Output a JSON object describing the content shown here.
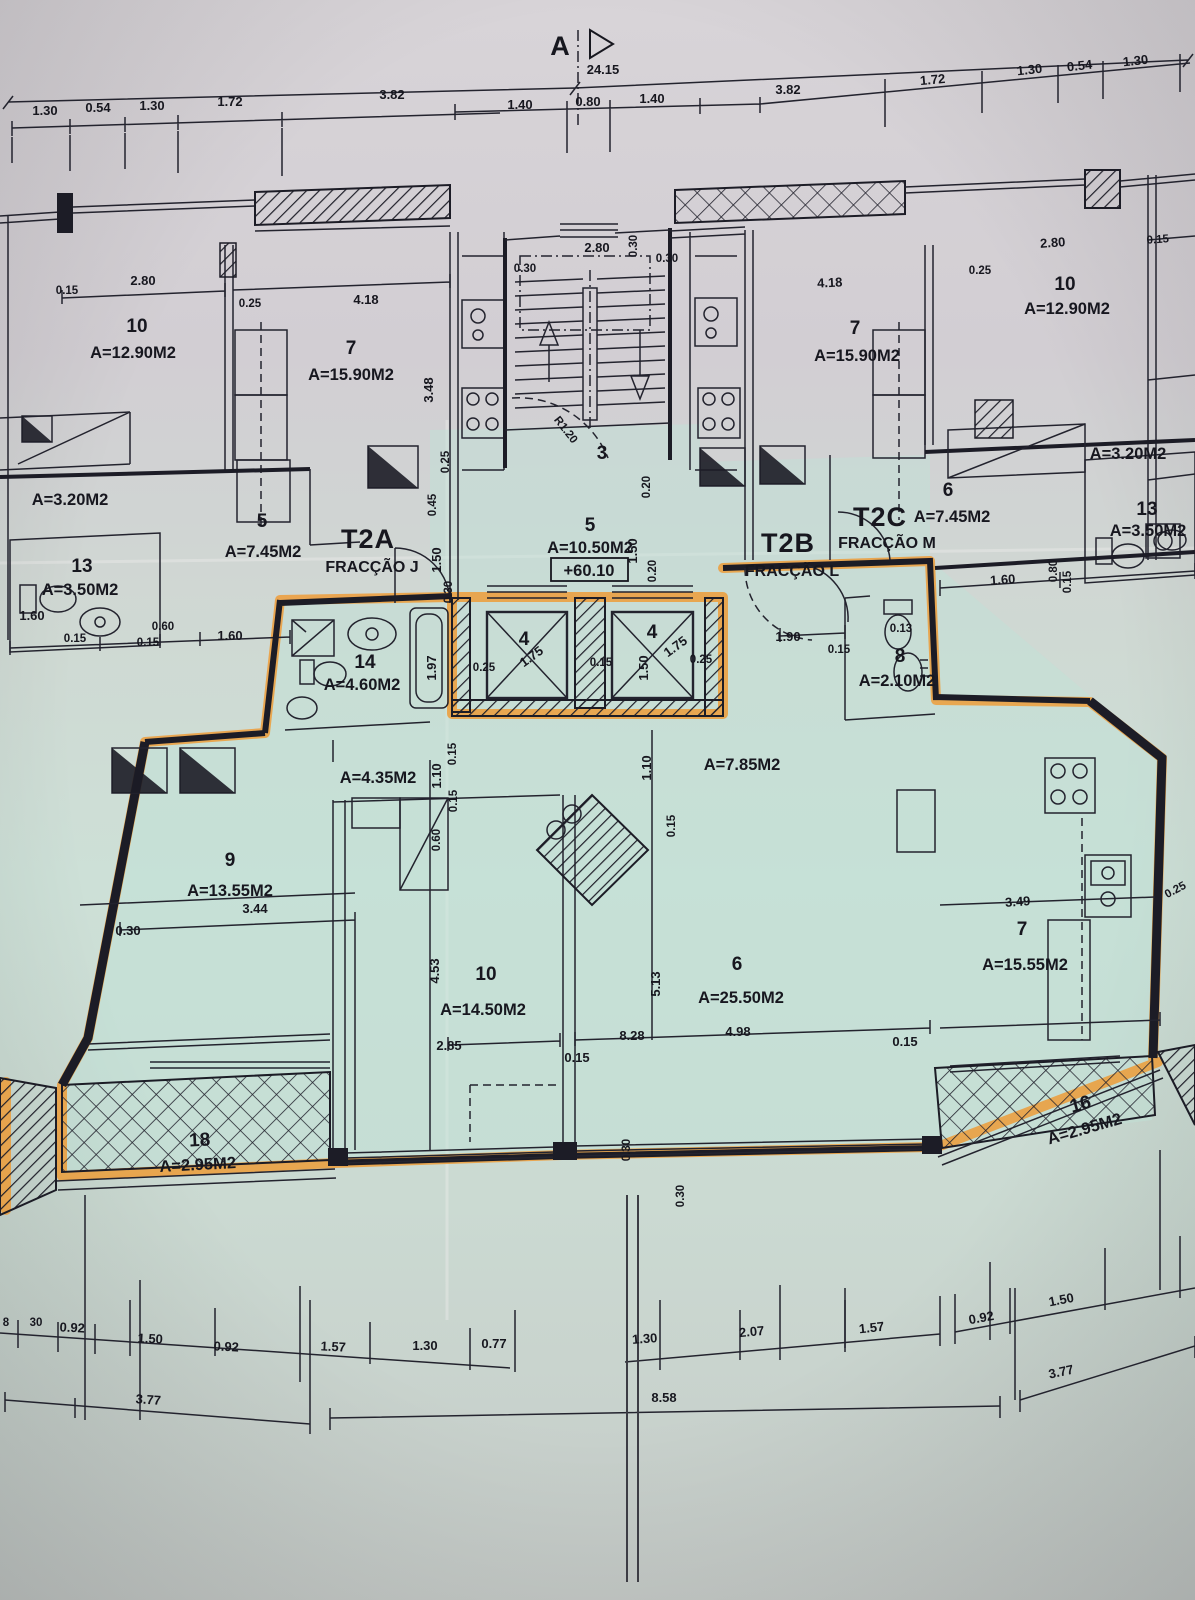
{
  "marker": {
    "label": "A",
    "overall": "24.15"
  },
  "top": {
    "left": [
      "1.30",
      "0.54",
      "1.30",
      "1.72",
      "3.82"
    ],
    "center": [
      "1.40",
      "0.80",
      "1.40"
    ],
    "right": [
      "3.82",
      "1.72",
      "1.30",
      "0.54",
      "1.30"
    ]
  },
  "upper_left": {
    "room10_num": "10",
    "room10_area": "A=12.90M2",
    "room7_num": "7",
    "room7_area": "A=15.90M2",
    "closet_area": "A=3.20M2",
    "hall5_num": "5",
    "hall5_area": "A=7.45M2",
    "bath13_num": "13",
    "bath13_area": "A=3.50M2",
    "dims": [
      "2.80",
      "0.15",
      "0.25",
      "4.18",
      "3.48",
      "0.45",
      "1.50",
      "1.60",
      "0.60",
      "0.15",
      "1.60",
      "0.15"
    ]
  },
  "center": {
    "stair_room": "3",
    "door_radius": "R1.20",
    "hall_num": "5",
    "hall_area": "A=10.50M2",
    "level": "+60.10",
    "dims": [
      "2.80",
      "0.30",
      "0.30",
      "0.30",
      "0.20",
      "1.50",
      "0.20",
      "0.30",
      "0.25"
    ]
  },
  "upper_right": {
    "room7_num": "7",
    "room7_area": "A=15.90M2",
    "room10_num": "10",
    "room10_area": "A=12.90M2",
    "closet_area": "A=3.20M2",
    "hall6_num": "6",
    "hall6_area": "A=7.45M2",
    "bath13_num": "13",
    "bath13_area": "A=3.50M2",
    "dims": [
      "4.18",
      "0.25",
      "2.80",
      "0.15",
      "1.60",
      "0.80",
      "0.15"
    ]
  },
  "fractions": {
    "t2a_code": "T2A",
    "t2a_name": "FRACÇÃO J",
    "t2b_code": "T2B",
    "t2b_name": "FRACÇÃO L",
    "t2c_code": "T2C",
    "t2c_name": "FRACÇÃO M"
  },
  "apartment": {
    "bath14_num": "14",
    "bath14_area": "A=4.60M2",
    "elev_num": "4",
    "elev_dim": "1.75",
    "core_dims": [
      "0.25",
      "0.15",
      "1.50",
      "0.25",
      "1.90",
      "0.15",
      "0.13",
      "1.97"
    ],
    "wc8_num": "8",
    "wc8_area": "A=2.10M2",
    "hall_left_area": "A=4.35M2",
    "hall_right_area": "A=7.85M2",
    "corr_dims": [
      "1.10",
      "0.15",
      "0.15",
      "0.60",
      "1.10",
      "0.15"
    ],
    "room9_num": "9",
    "room9_area": "A=13.55M2",
    "room9_dims": [
      "3.44",
      "0.30"
    ],
    "room10_num": "10",
    "room10_area": "A=14.50M2",
    "room10_dims": [
      "4.53",
      "2.85",
      "0.15"
    ],
    "room6_num": "6",
    "room6_area": "A=25.50M2",
    "room6_dims": [
      "5.13",
      "8.28",
      "4.98"
    ],
    "room7_num": "7",
    "room7_area": "A=15.55M2",
    "room7_dims": [
      "3.49",
      "0.25",
      "0.15"
    ],
    "balc18_num": "18",
    "balc18_area": "A=2.95M2",
    "balc16_num": "16",
    "balc16_area": "A=2.95M2",
    "edge_dims": [
      "0.30",
      "0.30"
    ]
  },
  "bottom": {
    "row1_left": [
      "8",
      "30",
      "0.92",
      "1.50",
      "0.92"
    ],
    "row1_center": [
      "1.57",
      "1.30",
      "0.77",
      "1.30",
      "2.07",
      "1.57"
    ],
    "row1_right": [
      "0.92",
      "1.50"
    ],
    "row2": [
      "3.77",
      "8.58",
      "3.77"
    ]
  },
  "colors": {
    "highlight": "#f0992f",
    "tint": "#bfe3d6",
    "ink": "#1c1c26"
  }
}
